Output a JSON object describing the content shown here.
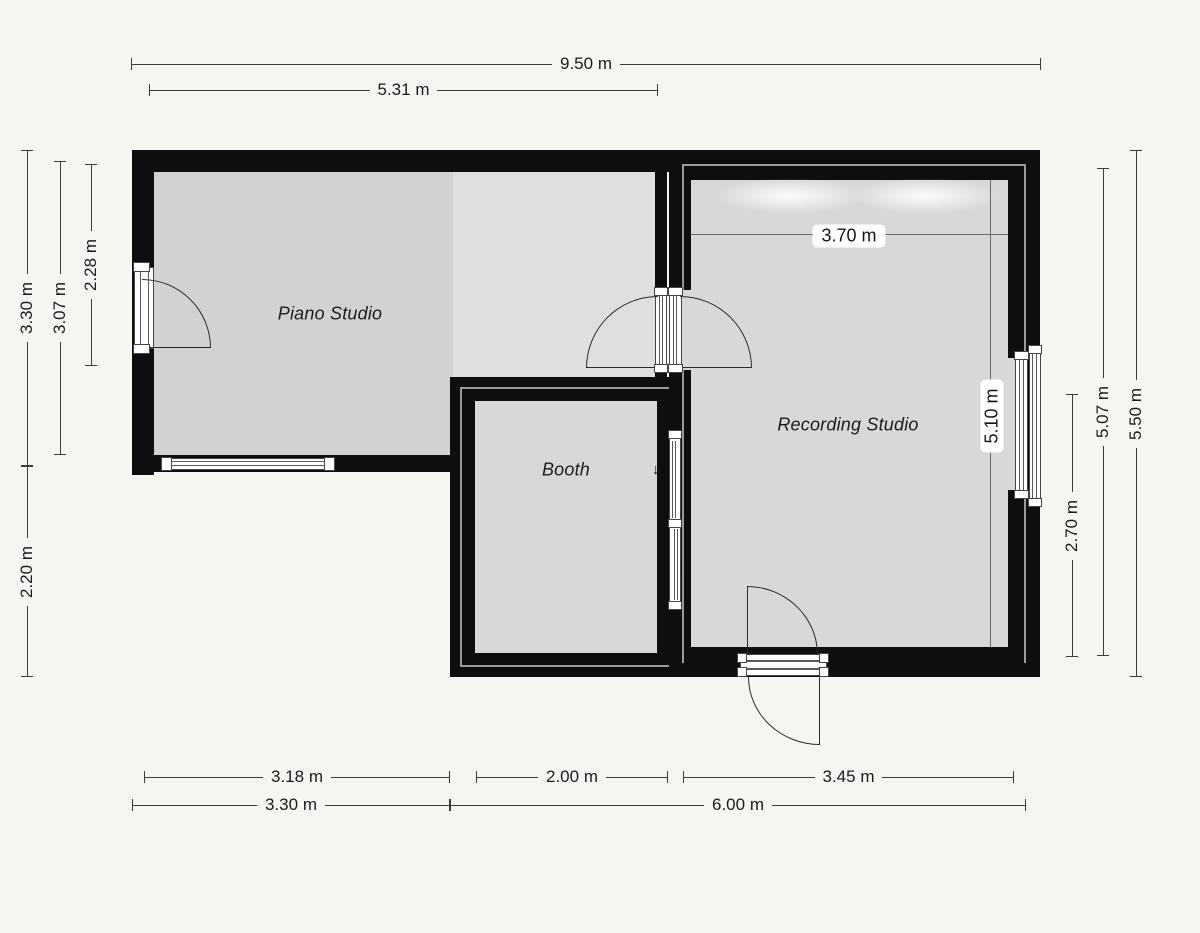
{
  "plan": {
    "type": "floor-plan",
    "rooms": {
      "piano": "Piano Studio",
      "booth": "Booth",
      "recording": "Recording Studio"
    },
    "interior_dims": {
      "recording_width": "3.70 m",
      "recording_height": "5.10 m"
    },
    "dims": {
      "top_total": "9.50 m",
      "top_left_span": "5.31 m",
      "left_upper": "3.30 m",
      "left_inner": "3.07 m",
      "left_door": "2.28 m",
      "left_lower": "2.20 m",
      "right_total": "5.50 m",
      "right_inner": "5.07 m",
      "right_lower": "2.70 m",
      "bottom_piano": "3.18 m",
      "bottom_booth": "2.00 m",
      "bottom_recording": "3.45 m",
      "bottom_left_total": "3.30 m",
      "bottom_right_total": "6.00 m"
    },
    "glyphs": {
      "slide_down": "↓",
      "slide_up": "↑"
    },
    "colors": {
      "background": "#f6f5f2",
      "wall": "#0e0e0e",
      "floor_piano": "#d2d2d2",
      "floor_hall": "#dfdfdf",
      "floor_room": "#d8d8d8",
      "wall_gap": "#9a9a9a",
      "dimension_line": "#3c3c3c"
    }
  }
}
